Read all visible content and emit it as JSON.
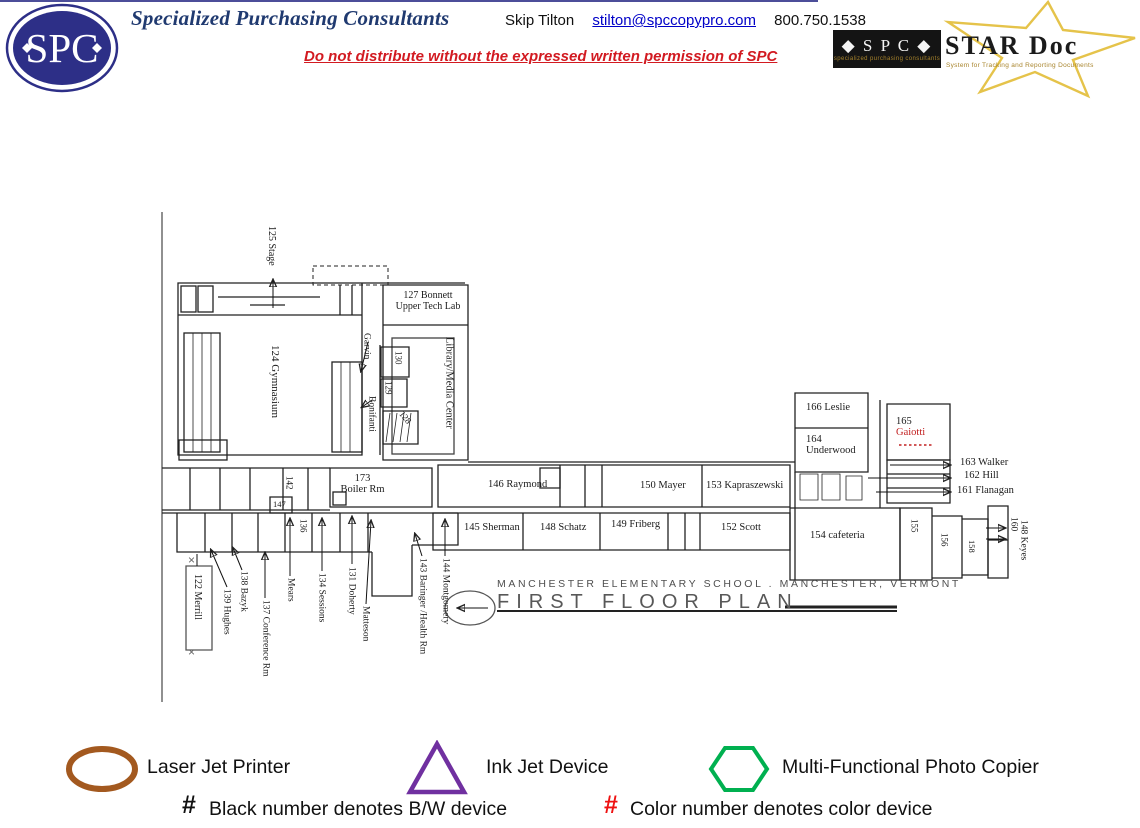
{
  "theme": {
    "navy": "#2d2f87",
    "title_blue": "#203a70",
    "notice_red": "#d21a21",
    "link_blue": "#0000c8",
    "star_gold": "#e5c34a",
    "gold_text": "#a8842c",
    "laser_brown": "#a3591f",
    "inkjet_purple": "#7030a0",
    "copier_green": "#00b050",
    "hash_red": "#ee1111"
  },
  "header": {
    "logo_text": "SPC",
    "company": "Specialized Purchasing Consultants",
    "contact_name": "Skip Tilton",
    "contact_email": "stilton@spccopypro.com",
    "contact_phone": "800.750.1538",
    "notice": "Do not distribute without the expressed written permission of SPC",
    "stardoc_spc": "◆ S P C ◆",
    "stardoc_spc_sub": "specialized purchasing consultants",
    "stardoc_title": "STAR Doc",
    "stardoc_subtitle": "System for Tracking and Reporting Documents"
  },
  "plan": {
    "school_title": "MANCHESTER ELEMENTARY SCHOOL .  MANCHESTER, VERMONT",
    "plan_title": "FIRST FLOOR PLAN",
    "rooms": {
      "stage": "125 Stage",
      "gym": "124 Gymnasium",
      "bonnett_1": "127 Bonnett",
      "bonnett_2": "Upper Tech Lab",
      "garvin": "Garvin",
      "r130": "130",
      "r129": "129",
      "bonifanti": "Bonifanti",
      "r128": "128",
      "library": "Library/Media Center",
      "boiler_1": "173",
      "boiler_2": "Boiler Rm",
      "r142": "142",
      "r147": "147",
      "r136": "136",
      "raymond": "146 Raymond",
      "mayer": "150 Mayer",
      "kapraszewski": "153 Kapraszewski",
      "sherman": "145 Sherman",
      "schatz": "148 Schatz",
      "friberg": "149 Friberg",
      "scott": "152 Scott",
      "montgomery": "144 Montgomery",
      "baringer": "143 Baringer /Health Rm",
      "merrill": "122 Merrill",
      "hughes": "139 Hughes",
      "bazyk": "138 Bazyk",
      "conference": "137 Conference Rm",
      "mears": "Mears",
      "sessions": "134 Sessions",
      "doherty": "131 Doherty",
      "matteson": "Matteson",
      "leslie": "166 Leslie",
      "underwood_1": "164",
      "underwood_2": "Underwood",
      "gaiotti_1": "165",
      "gaiotti_2": "Gaiotti",
      "walker": "163 Walker",
      "hill": "162 Hill",
      "flanagan": "161 Flanagan",
      "cafeteria": "154 cafeteria",
      "r155": "155",
      "r156": "156",
      "r158": "158",
      "r160": "160",
      "keyes": "148 Keyes"
    }
  },
  "legend": {
    "laser": "Laser Jet Printer",
    "inkjet": "Ink Jet Device",
    "copier": "Multi-Functional Photo Copier",
    "hash": "#",
    "bw_note": "Black number denotes B/W device",
    "color_note": "Color number denotes color device"
  }
}
